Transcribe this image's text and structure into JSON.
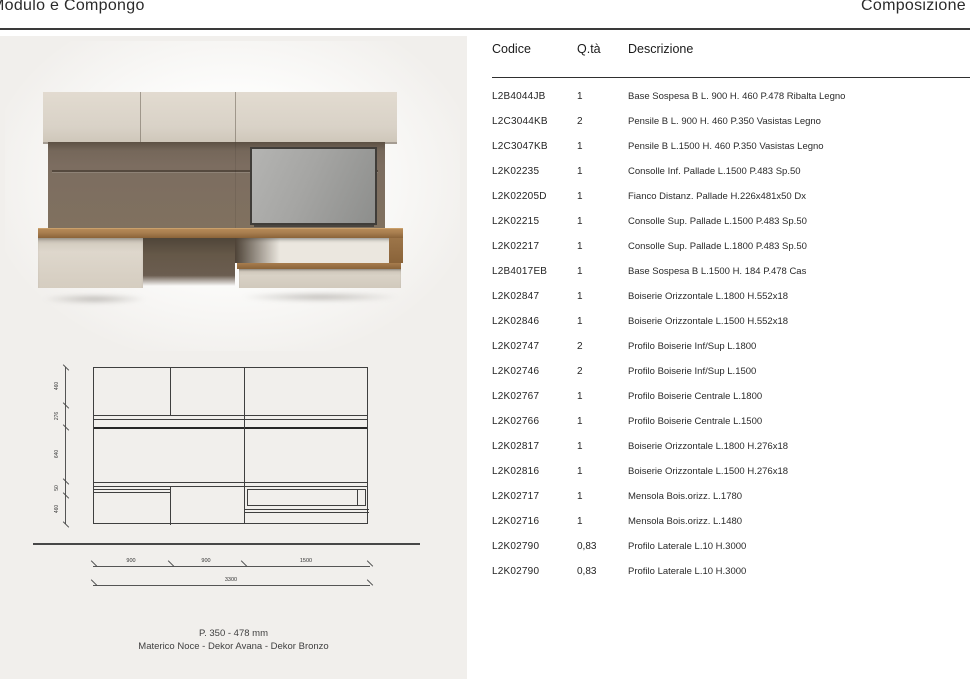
{
  "header": {
    "title_left": "Modulo e Compongo",
    "title_right": "Composizione"
  },
  "table": {
    "columns": [
      "Codice",
      "Q.tà",
      "Descrizione"
    ],
    "rows": [
      {
        "code": "L2B4044JB",
        "qty": "1",
        "desc": "Base Sospesa B L. 900 H. 460 P.478 Ribalta Legno"
      },
      {
        "code": "L2C3044KB",
        "qty": "2",
        "desc": "Pensile B L. 900 H. 460 P.350 Vasistas Legno"
      },
      {
        "code": "L2C3047KB",
        "qty": "1",
        "desc": "Pensile B L.1500 H. 460 P.350 Vasistas Legno"
      },
      {
        "code": "L2K02235",
        "qty": "1",
        "desc": "Consolle Inf. Pallade L.1500 P.483 Sp.50"
      },
      {
        "code": "L2K02205D",
        "qty": "1",
        "desc": "Fianco Distanz. Pallade H.226x481x50 Dx"
      },
      {
        "code": "L2K02215",
        "qty": "1",
        "desc": "Consolle Sup. Pallade L.1500 P.483 Sp.50"
      },
      {
        "code": "L2K02217",
        "qty": "1",
        "desc": "Consolle Sup. Pallade L.1800 P.483 Sp.50"
      },
      {
        "code": "L2B4017EB",
        "qty": "1",
        "desc": "Base Sospesa B L.1500 H. 184 P.478 Cas"
      },
      {
        "code": "L2K02847",
        "qty": "1",
        "desc": "Boiserie Orizzontale L.1800 H.552x18"
      },
      {
        "code": "L2K02846",
        "qty": "1",
        "desc": "Boiserie Orizzontale L.1500 H.552x18"
      },
      {
        "code": "L2K02747",
        "qty": "2",
        "desc": "Profilo Boiserie Inf/Sup L.1800"
      },
      {
        "code": "L2K02746",
        "qty": "2",
        "desc": "Profilo Boiserie Inf/Sup L.1500"
      },
      {
        "code": "L2K02767",
        "qty": "1",
        "desc": "Profilo Boiserie Centrale L.1800"
      },
      {
        "code": "L2K02766",
        "qty": "1",
        "desc": "Profilo Boiserie Centrale L.1500"
      },
      {
        "code": "L2K02817",
        "qty": "1",
        "desc": "Boiserie Orizzontale L.1800 H.276x18"
      },
      {
        "code": "L2K02816",
        "qty": "1",
        "desc": "Boiserie Orizzontale L.1500 H.276x18"
      },
      {
        "code": "L2K02717",
        "qty": "1",
        "desc": "Mensola Bois.orizz. L.1780"
      },
      {
        "code": "L2K02716",
        "qty": "1",
        "desc": "Mensola Bois.orizz. L.1480"
      },
      {
        "code": "L2K02790",
        "qty": "0,83",
        "desc": "Profilo Laterale L.10 H.3000"
      },
      {
        "code": "L2K02790",
        "qty": "0,83",
        "desc": "Profilo Laterale L.10 H.3000"
      }
    ]
  },
  "drawing": {
    "v_dims": [
      "460",
      "276",
      "640",
      "50",
      "460"
    ],
    "h_dims": [
      "900",
      "900",
      "1500"
    ],
    "total_width": "3300"
  },
  "caption": {
    "line1": "P. 350 - 478 mm",
    "line2": "Materico Noce - Dekor Avana - Dekor Bronzo"
  },
  "colors": {
    "panel_bg": "#f1efec",
    "cabinet": "#d9d2c7",
    "boiserie": "#7c6d60",
    "wood": "#a77d4e",
    "tv_frame": "#403d39",
    "rule": "#3a3a3a"
  }
}
